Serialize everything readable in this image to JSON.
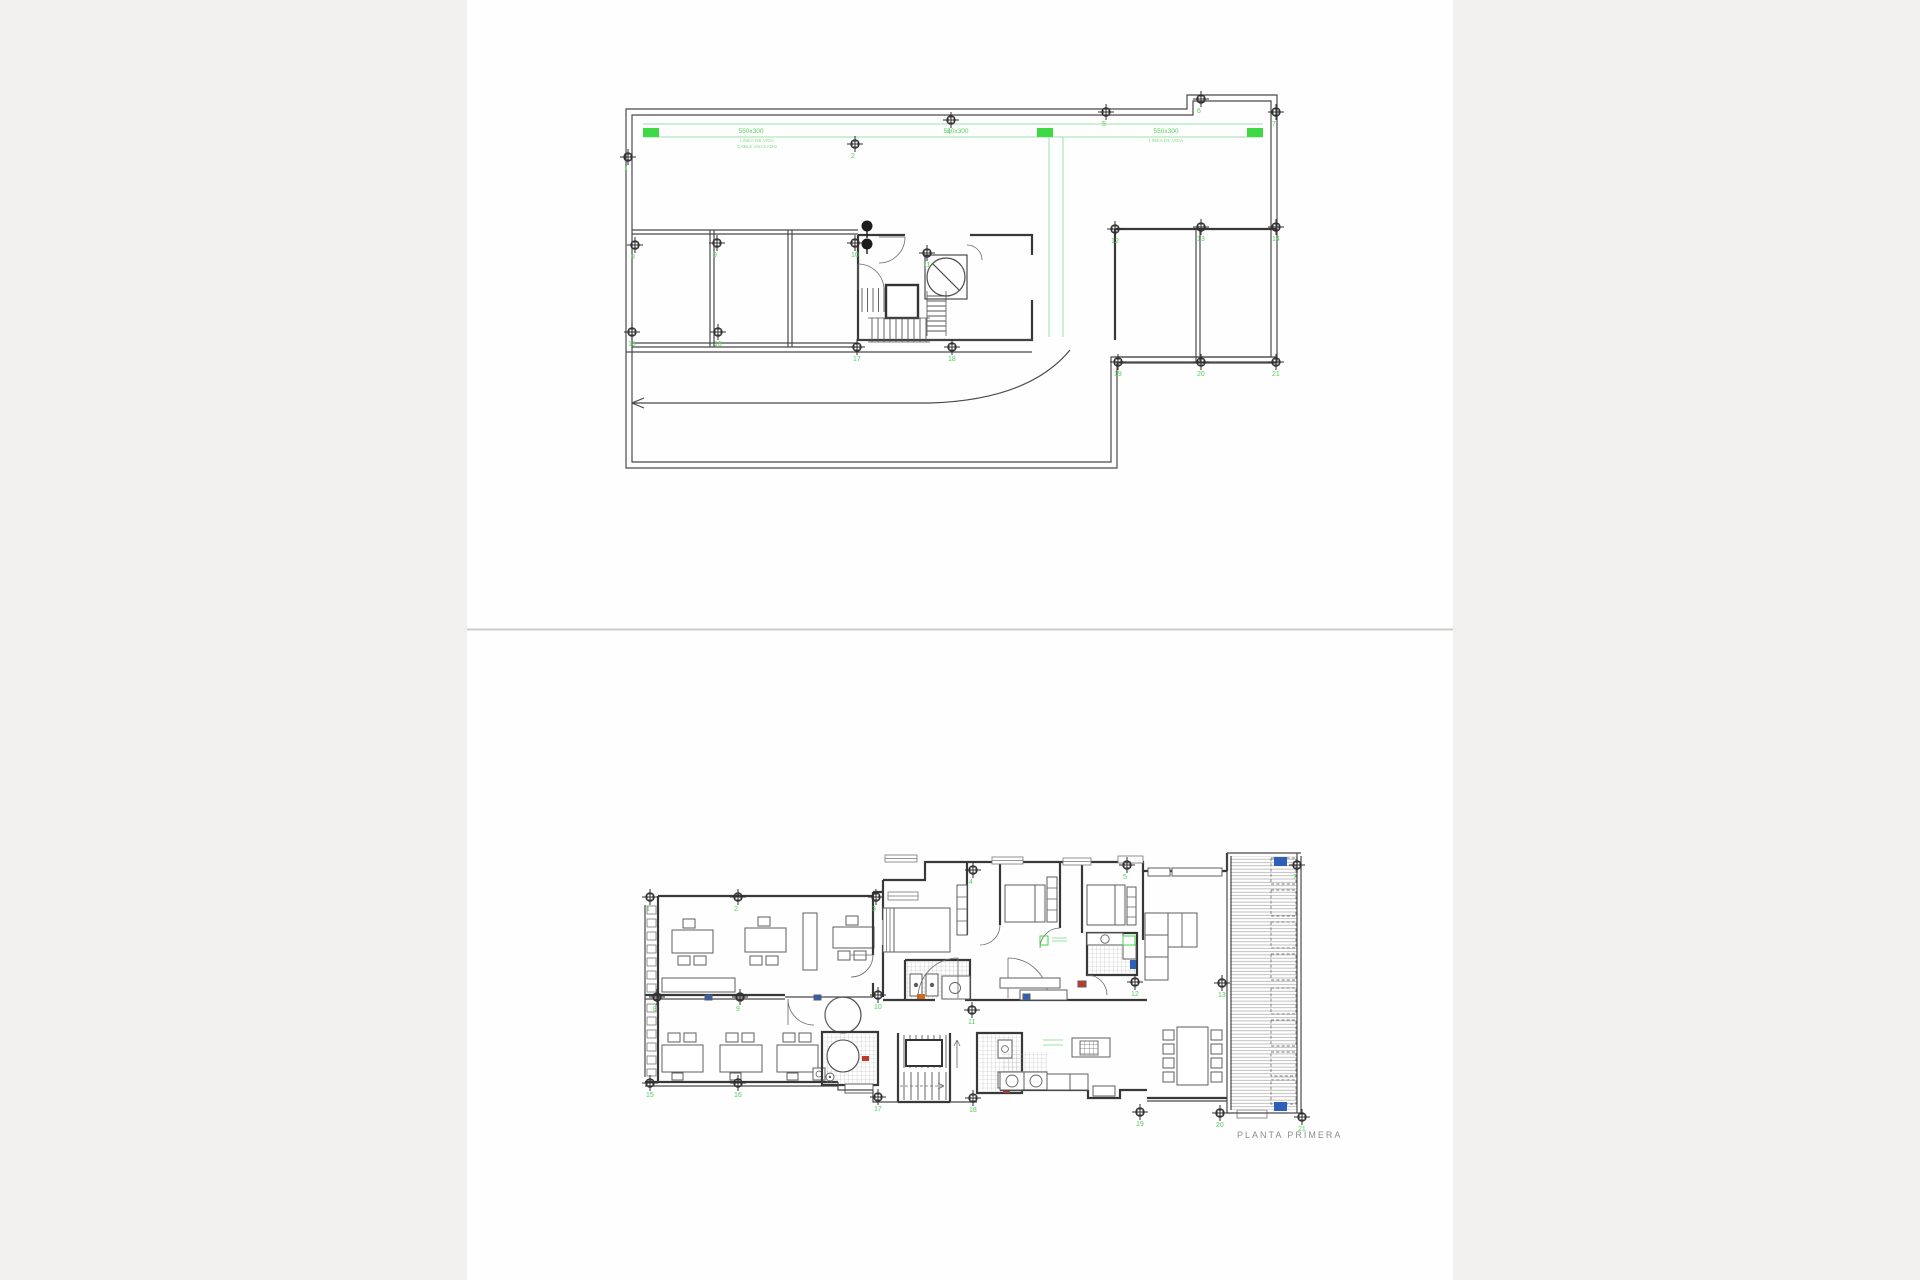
{
  "page": {
    "background": "#f2f1ef",
    "paper": "#fefefe",
    "divider_color": "#c9c9c8"
  },
  "colors": {
    "line": "#4a4a4a",
    "wall": "#383838",
    "annotation_green": "#3fd945",
    "annotation_green_light": "#9fe3a5",
    "marker_number_green": "#55cf5e",
    "hatch_gray": "#b5b5b5",
    "accent_blue": "#2e5fb8",
    "accent_red": "#c0392b",
    "accent_orange": "#d2691e",
    "title_gray": "#8c8c8c"
  },
  "roof_plan": {
    "green_labels": [
      {
        "text": "550x300",
        "x": 751,
        "y": 133,
        "subs": [
          {
            "t": "LINEA DE VIDA",
            "x": 757,
            "y": 142
          },
          {
            "t": "CABLE ANCLADO",
            "x": 757,
            "y": 148
          }
        ]
      },
      {
        "text": "550x300",
        "x": 956,
        "y": 133,
        "subs": []
      },
      {
        "text": "550x300",
        "x": 1166,
        "y": 133,
        "subs": [
          {
            "t": "LINEA DE VIDA",
            "x": 1166,
            "y": 142
          }
        ]
      }
    ],
    "markers": [
      {
        "n": "1",
        "x": 628,
        "y": 157
      },
      {
        "n": "2",
        "x": 855,
        "y": 144
      },
      {
        "n": "4",
        "x": 951,
        "y": 120
      },
      {
        "n": "5",
        "x": 1106,
        "y": 112
      },
      {
        "n": "6",
        "x": 1201,
        "y": 99
      },
      {
        "n": "7",
        "x": 1276,
        "y": 112
      },
      {
        "n": "8",
        "x": 635,
        "y": 245
      },
      {
        "n": "9",
        "x": 717,
        "y": 243
      },
      {
        "n": "10",
        "x": 855,
        "y": 243
      },
      {
        "n": "11",
        "x": 927,
        "y": 253
      },
      {
        "n": "12",
        "x": 1115,
        "y": 229
      },
      {
        "n": "13",
        "x": 1201,
        "y": 227
      },
      {
        "n": "14",
        "x": 1276,
        "y": 227
      },
      {
        "n": "15",
        "x": 632,
        "y": 332
      },
      {
        "n": "16",
        "x": 718,
        "y": 332
      },
      {
        "n": "17",
        "x": 857,
        "y": 347
      },
      {
        "n": "18",
        "x": 952,
        "y": 347
      },
      {
        "n": "19",
        "x": 1118,
        "y": 362
      },
      {
        "n": "20",
        "x": 1201,
        "y": 362
      },
      {
        "n": "21",
        "x": 1276,
        "y": 362
      }
    ]
  },
  "first_floor_plan": {
    "title": "PLANTA PRIMERA",
    "markers": [
      {
        "n": "1",
        "x": 650,
        "y": 897
      },
      {
        "n": "2",
        "x": 738,
        "y": 897
      },
      {
        "n": "3",
        "x": 876,
        "y": 897
      },
      {
        "n": "4",
        "x": 973,
        "y": 870
      },
      {
        "n": "5",
        "x": 1127,
        "y": 865
      },
      {
        "n": "7",
        "x": 1297,
        "y": 865
      },
      {
        "n": "8",
        "x": 657,
        "y": 997
      },
      {
        "n": "9",
        "x": 740,
        "y": 997
      },
      {
        "n": "10",
        "x": 878,
        "y": 995
      },
      {
        "n": "11",
        "x": 972,
        "y": 1010
      },
      {
        "n": "12",
        "x": 1135,
        "y": 982
      },
      {
        "n": "13",
        "x": 1222,
        "y": 983
      },
      {
        "n": "15",
        "x": 650,
        "y": 1083
      },
      {
        "n": "16",
        "x": 738,
        "y": 1083
      },
      {
        "n": "17",
        "x": 878,
        "y": 1097
      },
      {
        "n": "18",
        "x": 973,
        "y": 1098
      },
      {
        "n": "19",
        "x": 1140,
        "y": 1112
      },
      {
        "n": "20",
        "x": 1220,
        "y": 1113
      },
      {
        "n": "21",
        "x": 1302,
        "y": 1117
      }
    ]
  }
}
